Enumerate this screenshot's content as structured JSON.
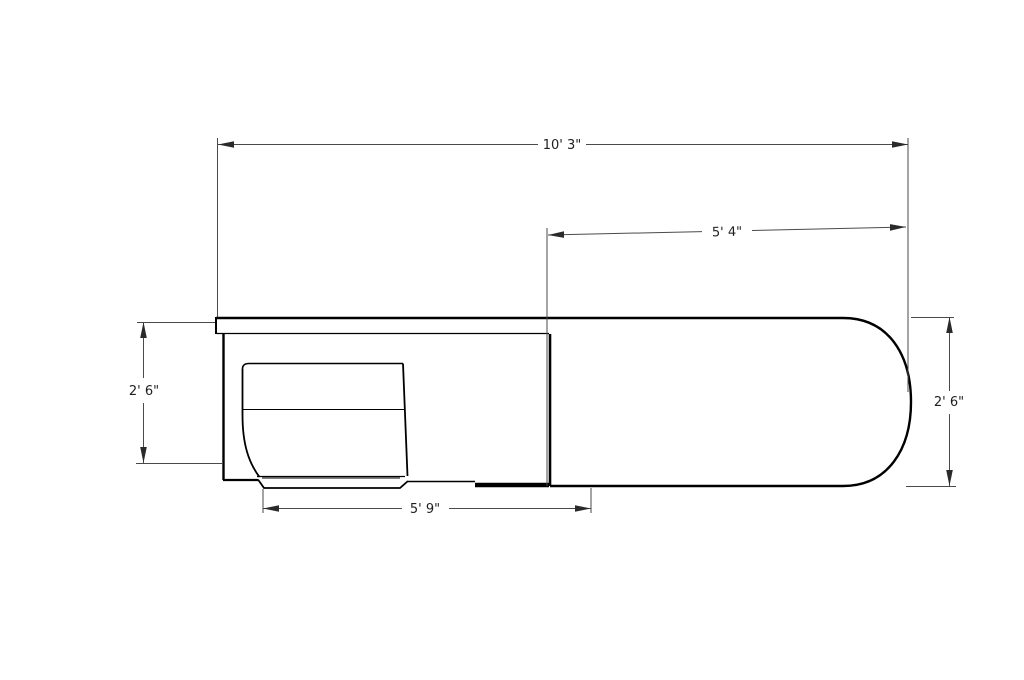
{
  "drawing": {
    "background": "#ffffff",
    "line_color": "#000000",
    "dimension_color": "#4a4a4a",
    "text_color": "#1f1f1f",
    "labels": {
      "overall_length": "10' 3\"",
      "counter_length": "5' 4\"",
      "depth_left": "2' 6\"",
      "depth_right": "2' 6\"",
      "base_length": "5' 9\""
    }
  }
}
